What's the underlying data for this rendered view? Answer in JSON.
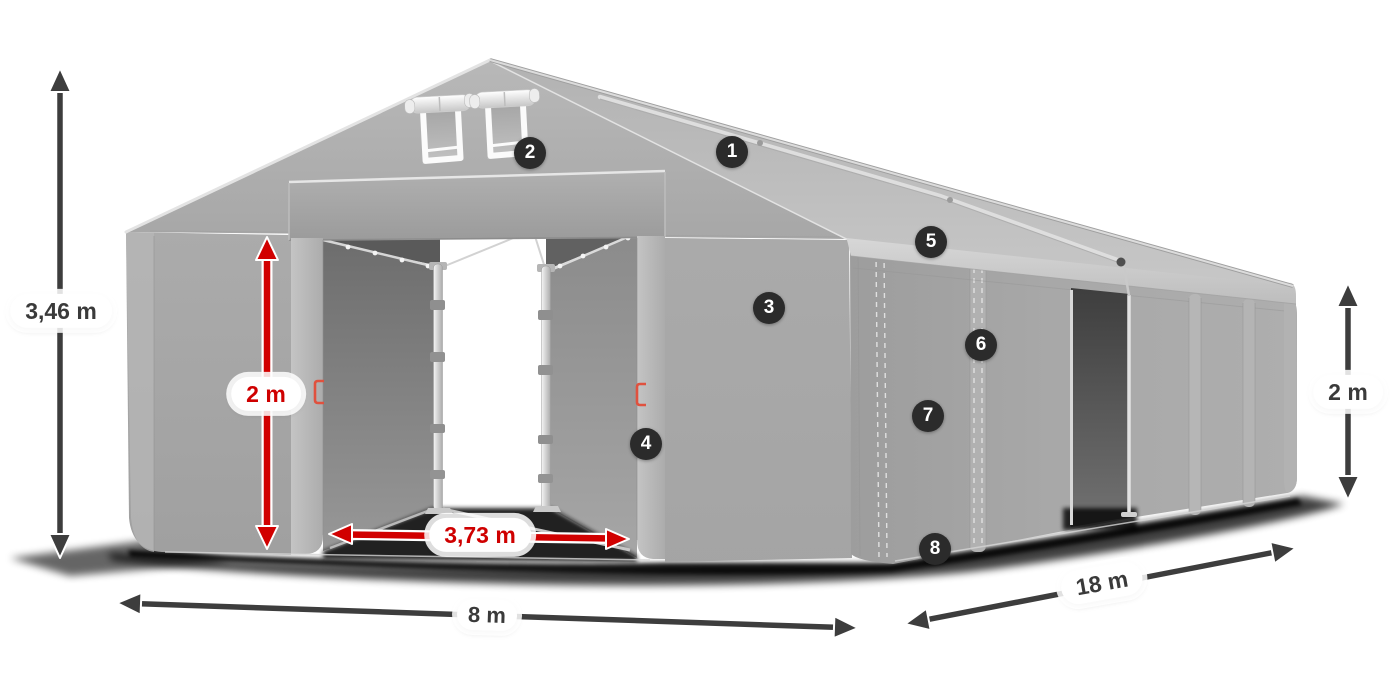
{
  "diagram": {
    "title": "Tent dimension diagram",
    "measurements": {
      "total_height": "3,46 m",
      "entrance_height": "2 m",
      "entrance_width": "3,73 m",
      "front_width": "8 m",
      "side_length": "18 m",
      "side_wall_height": "2 m"
    },
    "callouts": [
      {
        "number": "1"
      },
      {
        "number": "2"
      },
      {
        "number": "3"
      },
      {
        "number": "4"
      },
      {
        "number": "5"
      },
      {
        "number": "6"
      },
      {
        "number": "7"
      },
      {
        "number": "8"
      }
    ],
    "colors": {
      "dimension_arrow": "#3d3d3d",
      "accent_red": "#d10000",
      "callout_badge": "#2b2b2b",
      "tent_fabric": "#ababab"
    }
  }
}
